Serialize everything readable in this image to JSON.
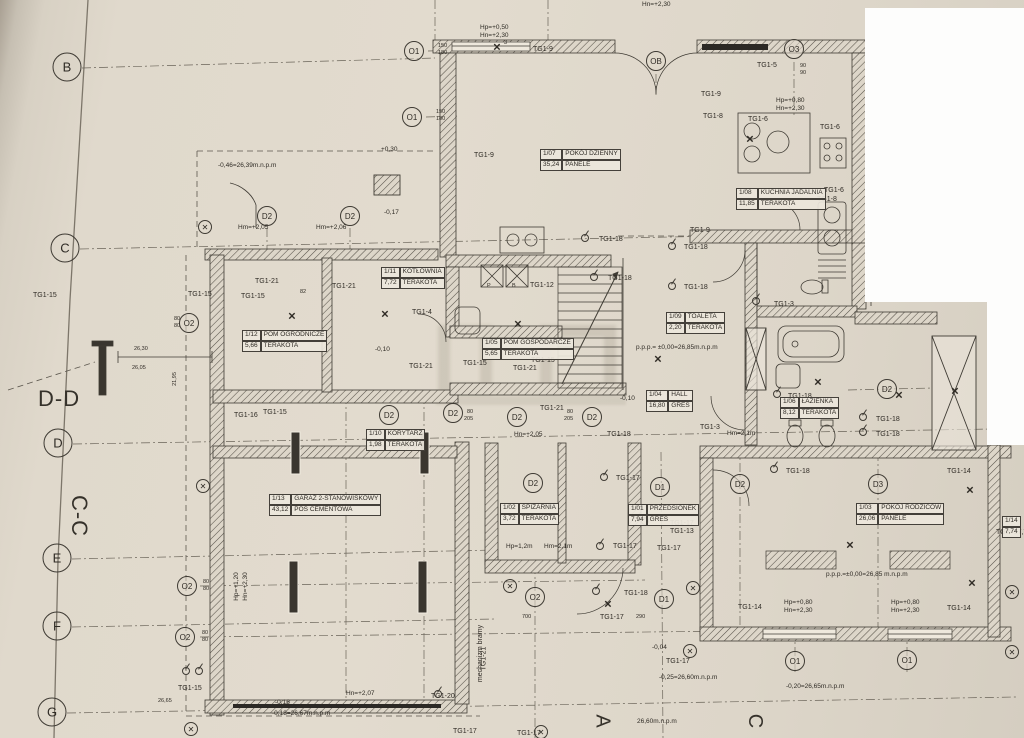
{
  "glyphs": {
    "x": "✕"
  },
  "rooms": [
    {
      "id": "1/07",
      "name": "POKÓJ DZIENNY",
      "area": "35,24",
      "floor": "PANELE",
      "x": 540,
      "y": 149
    },
    {
      "id": "1/08",
      "name": "KUCHNIA JADALNIA",
      "area": "11,85",
      "floor": "TERAKOTA",
      "x": 736,
      "y": 188
    },
    {
      "id": "1/09",
      "name": "TOALETA",
      "area": "2,20",
      "floor": "TERAKOTA",
      "x": 666,
      "y": 312
    },
    {
      "id": "1/11",
      "name": "KOTŁOWNIA",
      "area": "7,72",
      "floor": "TERAKOTA",
      "x": 381,
      "y": 267
    },
    {
      "id": "1/12",
      "name": "POM OGRODNICZE",
      "area": "5,66",
      "floor": "TERAKOTA",
      "x": 242,
      "y": 330
    },
    {
      "id": "1/05",
      "name": "POM GOSPODARCZE",
      "area": "5,65",
      "floor": "TERAKOTA",
      "x": 482,
      "y": 338
    },
    {
      "id": "1/04",
      "name": "HALL",
      "area": "16,80",
      "floor": "GRES",
      "x": 646,
      "y": 390
    },
    {
      "id": "1/06",
      "name": "ŁAZIENKA",
      "area": "8,12",
      "floor": "TERAKOTA",
      "x": 780,
      "y": 397
    },
    {
      "id": "1/10",
      "name": "KORYTARZ",
      "area": "1,98",
      "floor": "TERAKOTA",
      "x": 366,
      "y": 429
    },
    {
      "id": "1/13",
      "name": "GARAŻ 2-STANOWISKOWY",
      "area": "43,12",
      "floor": "POS CEMENTOWA",
      "x": 269,
      "y": 494
    },
    {
      "id": "1/02",
      "name": "SPIŻARNIA",
      "area": "3,72",
      "floor": "TERAKOTA",
      "x": 500,
      "y": 503
    },
    {
      "id": "1/01",
      "name": "PRZEDSIONEK",
      "area": "7,94",
      "floor": "GRES",
      "x": 628,
      "y": 504
    },
    {
      "id": "1/03",
      "name": "POKÓJ RODZICÓW",
      "area": "26,06",
      "floor": "PANELE",
      "x": 856,
      "y": 503
    },
    {
      "id": "1/14",
      "name": "",
      "area": "7,74",
      "floor": "",
      "x": 1002,
      "y": 516
    }
  ],
  "grid_markers": [
    {
      "t": "B",
      "x": 67,
      "y": 67
    },
    {
      "t": "C",
      "x": 65,
      "y": 248
    },
    {
      "t": "D",
      "x": 58,
      "y": 443
    },
    {
      "t": "E",
      "x": 57,
      "y": 558
    },
    {
      "t": "F",
      "x": 57,
      "y": 626
    },
    {
      "t": "G",
      "x": 52,
      "y": 712
    }
  ],
  "axis_markers": [
    {
      "t": "O1",
      "x": 414,
      "y": 51
    },
    {
      "t": "O1",
      "x": 412,
      "y": 117
    },
    {
      "t": "OB",
      "x": 656,
      "y": 61
    },
    {
      "t": "O3",
      "x": 794,
      "y": 49
    },
    {
      "t": "O2",
      "x": 189,
      "y": 323
    },
    {
      "t": "O2",
      "x": 187,
      "y": 586
    },
    {
      "t": "O2",
      "x": 185,
      "y": 637
    },
    {
      "t": "O2",
      "x": 535,
      "y": 597
    },
    {
      "t": "D1",
      "x": 660,
      "y": 487
    },
    {
      "t": "D1",
      "x": 664,
      "y": 599
    },
    {
      "t": "D2",
      "x": 267,
      "y": 216
    },
    {
      "t": "D2",
      "x": 350,
      "y": 216
    },
    {
      "t": "D2",
      "x": 389,
      "y": 415
    },
    {
      "t": "D2",
      "x": 453,
      "y": 413
    },
    {
      "t": "D2",
      "x": 517,
      "y": 417
    },
    {
      "t": "D2",
      "x": 592,
      "y": 417
    },
    {
      "t": "D2",
      "x": 533,
      "y": 483
    },
    {
      "t": "D2",
      "x": 740,
      "y": 484
    },
    {
      "t": "D2",
      "x": 887,
      "y": 389
    },
    {
      "t": "D3",
      "x": 878,
      "y": 484
    },
    {
      "t": "O1",
      "x": 795,
      "y": 661
    },
    {
      "t": "O1",
      "x": 907,
      "y": 660
    }
  ],
  "tg_labels": [
    {
      "t": "TG1-9",
      "x": 533,
      "y": 46
    },
    {
      "t": "TG1-9",
      "x": 474,
      "y": 152
    },
    {
      "t": "TG1-9",
      "x": 701,
      "y": 91
    },
    {
      "t": "TG1-9",
      "x": 690,
      "y": 227
    },
    {
      "t": "TG1-5",
      "x": 757,
      "y": 62
    },
    {
      "t": "TG1-6",
      "x": 820,
      "y": 124
    },
    {
      "t": "TG1-6",
      "x": 824,
      "y": 187
    },
    {
      "t": "TG1-6",
      "x": 748,
      "y": 116
    },
    {
      "t": "TG1-8",
      "x": 817,
      "y": 196
    },
    {
      "t": "TG1-8",
      "x": 703,
      "y": 113
    },
    {
      "t": "TG1-12",
      "x": 530,
      "y": 282
    },
    {
      "t": "TG1-4",
      "x": 412,
      "y": 309
    },
    {
      "t": "TG1-15",
      "x": 33,
      "y": 292
    },
    {
      "t": "TG1-15",
      "x": 188,
      "y": 291
    },
    {
      "t": "TG1-15",
      "x": 241,
      "y": 293
    },
    {
      "t": "TG1-15",
      "x": 263,
      "y": 409
    },
    {
      "t": "TG1-15",
      "x": 463,
      "y": 360
    },
    {
      "t": "TG1-15",
      "x": 531,
      "y": 357
    },
    {
      "t": "TG1-15",
      "x": 178,
      "y": 685
    },
    {
      "t": "TG1-21",
      "x": 255,
      "y": 278
    },
    {
      "t": "TG1-21",
      "x": 332,
      "y": 283
    },
    {
      "t": "TG1-21",
      "x": 409,
      "y": 363
    },
    {
      "t": "TG1-21",
      "x": 513,
      "y": 365
    },
    {
      "t": "TG1-21",
      "x": 540,
      "y": 405
    },
    {
      "t": "TG1-21",
      "x": 472,
      "y": 655,
      "rot": -90
    },
    {
      "t": "TG1-16",
      "x": 234,
      "y": 412
    },
    {
      "t": "TG1-18",
      "x": 599,
      "y": 236
    },
    {
      "t": "TG1-18",
      "x": 684,
      "y": 244
    },
    {
      "t": "TG1-18",
      "x": 608,
      "y": 275
    },
    {
      "t": "TG1-18",
      "x": 684,
      "y": 284
    },
    {
      "t": "TG1-18",
      "x": 788,
      "y": 393
    },
    {
      "t": "TG1-18",
      "x": 876,
      "y": 416
    },
    {
      "t": "TG1-18",
      "x": 876,
      "y": 431
    },
    {
      "t": "TG1-18",
      "x": 786,
      "y": 468
    },
    {
      "t": "TG1-18",
      "x": 607,
      "y": 431
    },
    {
      "t": "TG1-18",
      "x": 624,
      "y": 590
    },
    {
      "t": "TG1-17",
      "x": 616,
      "y": 475
    },
    {
      "t": "TG1-17",
      "x": 670,
      "y": 520
    },
    {
      "t": "TG1-17",
      "x": 657,
      "y": 545
    },
    {
      "t": "TG1-17",
      "x": 613,
      "y": 543
    },
    {
      "t": "TG1-17",
      "x": 600,
      "y": 614
    },
    {
      "t": "TG1-17",
      "x": 666,
      "y": 658
    },
    {
      "t": "TG1-17",
      "x": 453,
      "y": 728
    },
    {
      "t": "TG1-17",
      "x": 517,
      "y": 730
    },
    {
      "t": "TG1-13",
      "x": 670,
      "y": 528
    },
    {
      "t": "TG1-14",
      "x": 738,
      "y": 604
    },
    {
      "t": "TG1-14",
      "x": 947,
      "y": 468
    },
    {
      "t": "TG1-14",
      "x": 947,
      "y": 605
    },
    {
      "t": "TG1-3",
      "x": 774,
      "y": 301
    },
    {
      "t": "TG1-3",
      "x": 700,
      "y": 424
    },
    {
      "t": "TG1-20",
      "x": 431,
      "y": 693
    },
    {
      "t": "TG2=17,7",
      "x": 996,
      "y": 529
    },
    {
      "t": "mechanizm bramy",
      "x": 452,
      "y": 650,
      "rot": -90
    }
  ],
  "level_labels": [
    {
      "t": "p.p.p.= ±0,00=26,85m.n.p.m",
      "x": 636,
      "y": 344
    },
    {
      "t": "p.p.p.=±0,00=26,85 m.n.p.m",
      "x": 826,
      "y": 571
    },
    {
      "t": "-0,25=26,60m.n.p.m",
      "x": 659,
      "y": 674
    },
    {
      "t": "-0,20=26,65m.n.p.m",
      "x": 786,
      "y": 683
    },
    {
      "t": "26,60m.n.p.m",
      "x": 637,
      "y": 718
    },
    {
      "t": "-0,18=26,67m.n.p.m",
      "x": 272,
      "y": 710
    },
    {
      "t": "-0,46=26,39m.n.p.m",
      "x": 218,
      "y": 162
    },
    {
      "t": "-0,16",
      "x": 275,
      "y": 699
    },
    {
      "t": "-0,04",
      "x": 652,
      "y": 644
    },
    {
      "t": "-0,10",
      "x": 375,
      "y": 346
    },
    {
      "t": "-0,10",
      "x": 620,
      "y": 395
    },
    {
      "t": "+0,30",
      "x": 381,
      "y": 146
    },
    {
      "t": "-0,17",
      "x": 384,
      "y": 209
    }
  ],
  "hn_labels": [
    {
      "t": "Hp=+0,50",
      "x": 480,
      "y": 24
    },
    {
      "t": "Hn=+2,30",
      "x": 480,
      "y": 32
    },
    {
      "t": "Hn=+2,30",
      "x": 642,
      "y": 1
    },
    {
      "t": "Hp=+0,80",
      "x": 776,
      "y": 97
    },
    {
      "t": "Hn=+2,30",
      "x": 776,
      "y": 105
    },
    {
      "t": "Hp=+0,80",
      "x": 784,
      "y": 599
    },
    {
      "t": "Hn=+2,30",
      "x": 784,
      "y": 607
    },
    {
      "t": "Hp=+0,80",
      "x": 891,
      "y": 599
    },
    {
      "t": "Hn=+2,30",
      "x": 891,
      "y": 607
    },
    {
      "t": "Hm=+2,05",
      "x": 238,
      "y": 224
    },
    {
      "t": "Hm=+2,06",
      "x": 316,
      "y": 224
    },
    {
      "t": "Hn=+2,05",
      "x": 514,
      "y": 431
    },
    {
      "t": "Hn=+2,07",
      "x": 346,
      "y": 690
    },
    {
      "t": "Hm=2,1m",
      "x": 727,
      "y": 430
    },
    {
      "t": "Hp=1,2m",
      "x": 506,
      "y": 543
    },
    {
      "t": "Hm=2,1m",
      "x": 544,
      "y": 543
    },
    {
      "t": "Hp=+1,20",
      "x": 222,
      "y": 583,
      "rot": -90
    },
    {
      "t": "Hn=+2,30",
      "x": 231,
      "y": 583,
      "rot": -90
    }
  ],
  "dim_labels": [
    {
      "t": "150",
      "x": 438,
      "y": 43
    },
    {
      "t": "180",
      "x": 438,
      "y": 50
    },
    {
      "t": "150",
      "x": 436,
      "y": 109
    },
    {
      "t": "180",
      "x": 436,
      "y": 116
    },
    {
      "t": "90",
      "x": 800,
      "y": 63
    },
    {
      "t": "90",
      "x": 800,
      "y": 70
    },
    {
      "t": "80",
      "x": 174,
      "y": 316
    },
    {
      "t": "80",
      "x": 174,
      "y": 323
    },
    {
      "t": "80",
      "x": 203,
      "y": 579
    },
    {
      "t": "80",
      "x": 203,
      "y": 586
    },
    {
      "t": "80",
      "x": 202,
      "y": 630
    },
    {
      "t": "80",
      "x": 202,
      "y": 637
    },
    {
      "t": "82",
      "x": 300,
      "y": 289
    },
    {
      "t": "700",
      "x": 522,
      "y": 614
    },
    {
      "t": "290",
      "x": 636,
      "y": 614
    },
    {
      "t": "80",
      "x": 567,
      "y": 409
    },
    {
      "t": "205",
      "x": 564,
      "y": 416
    },
    {
      "t": "80",
      "x": 467,
      "y": 409
    },
    {
      "t": "205",
      "x": 464,
      "y": 416
    },
    {
      "t": "26,30",
      "x": 134,
      "y": 346
    },
    {
      "t": "26,05",
      "x": 132,
      "y": 365
    },
    {
      "t": "21,95",
      "x": 168,
      "y": 376,
      "rot": -90
    },
    {
      "t": "26,65",
      "x": 158,
      "y": 698
    },
    {
      "t": "3",
      "x": 504,
      "y": 40
    },
    {
      "t": "P",
      "x": 487,
      "y": 283
    },
    {
      "t": "B",
      "x": 512,
      "y": 283
    }
  ],
  "section_labels": [
    {
      "t": "D-D",
      "x": 38,
      "y": 386,
      "fs": 22
    },
    {
      "t": "C-C",
      "x": 58,
      "y": 503,
      "fs": 22,
      "rot": 90
    },
    {
      "t": "A",
      "x": 595,
      "y": 710,
      "fs": 20,
      "rot": 90
    },
    {
      "t": "C",
      "x": 747,
      "y": 710,
      "fs": 20,
      "rot": 90
    }
  ],
  "xmarks": [
    {
      "x": 497,
      "y": 48
    },
    {
      "x": 292,
      "y": 317
    },
    {
      "x": 385,
      "y": 315
    },
    {
      "x": 750,
      "y": 140
    },
    {
      "x": 658,
      "y": 360
    },
    {
      "x": 818,
      "y": 383
    },
    {
      "x": 899,
      "y": 396
    },
    {
      "x": 955,
      "y": 392
    },
    {
      "x": 850,
      "y": 546
    },
    {
      "x": 970,
      "y": 491
    },
    {
      "x": 972,
      "y": 584
    },
    {
      "x": 608,
      "y": 605
    },
    {
      "x": 518,
      "y": 325
    }
  ],
  "oxmarks": [
    {
      "x": 205,
      "y": 227
    },
    {
      "x": 203,
      "y": 486
    },
    {
      "x": 510,
      "y": 586
    },
    {
      "x": 693,
      "y": 588
    },
    {
      "x": 690,
      "y": 651
    },
    {
      "x": 1012,
      "y": 592
    },
    {
      "x": 1012,
      "y": 652
    },
    {
      "x": 191,
      "y": 729
    },
    {
      "x": 541,
      "y": 732
    }
  ],
  "sockets": [
    {
      "x": 585,
      "y": 238
    },
    {
      "x": 672,
      "y": 246
    },
    {
      "x": 594,
      "y": 277
    },
    {
      "x": 672,
      "y": 286
    },
    {
      "x": 777,
      "y": 394
    },
    {
      "x": 863,
      "y": 417
    },
    {
      "x": 863,
      "y": 432
    },
    {
      "x": 774,
      "y": 469
    },
    {
      "x": 596,
      "y": 591
    },
    {
      "x": 604,
      "y": 477
    },
    {
      "x": 645,
      "y": 521
    },
    {
      "x": 600,
      "y": 546
    },
    {
      "x": 438,
      "y": 694
    },
    {
      "x": 186,
      "y": 671
    },
    {
      "x": 199,
      "y": 671
    },
    {
      "x": 756,
      "y": 301
    }
  ]
}
